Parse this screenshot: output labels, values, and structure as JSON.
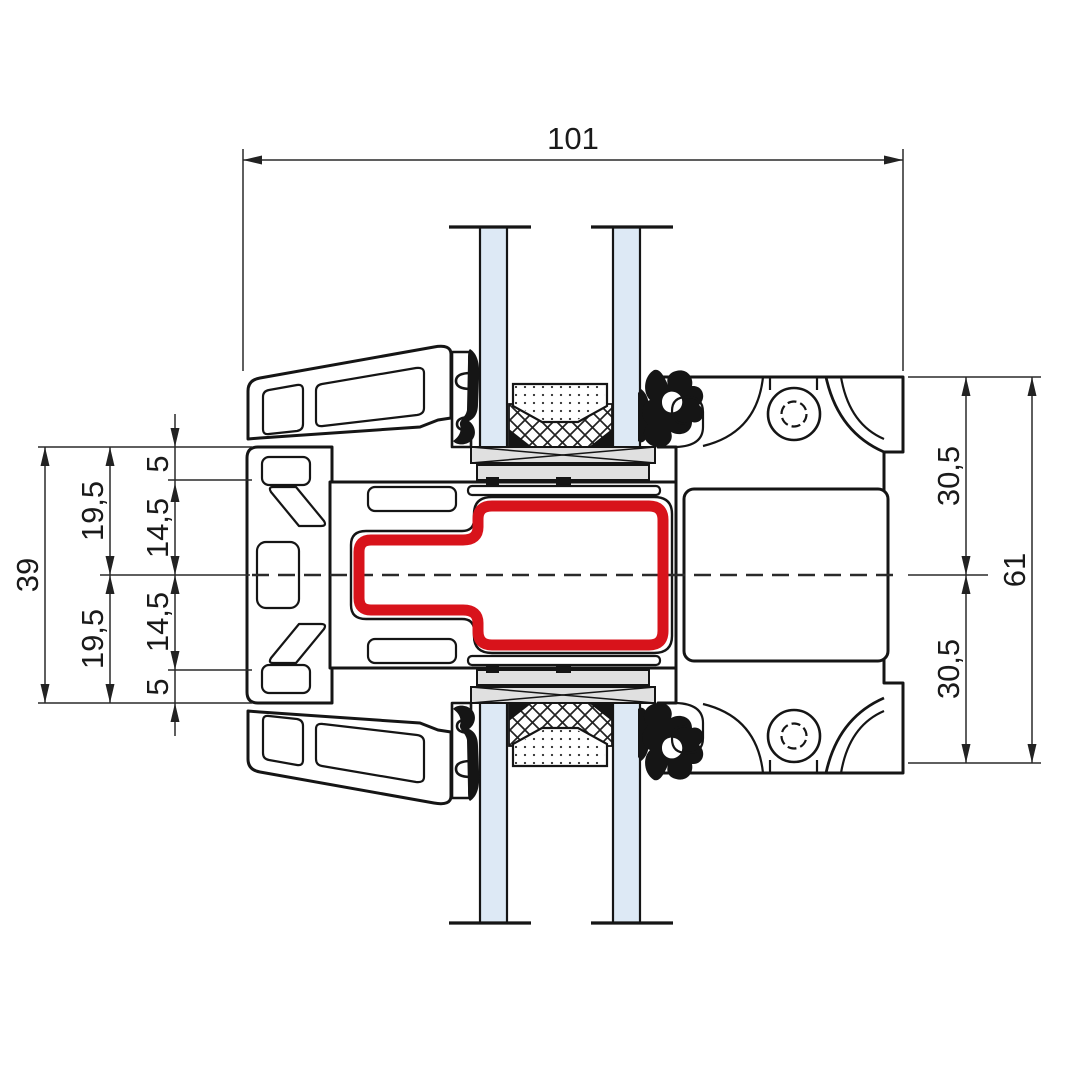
{
  "drawing": {
    "title": "Window mullion profile cross-section",
    "dimensions": {
      "total_width": "101",
      "left_overall": "39",
      "left_upper_half": "19,5",
      "left_lower_half": "19,5",
      "left_wall_top": "5",
      "left_inner_upper": "14,5",
      "left_inner_lower": "14,5",
      "left_wall_bottom": "5",
      "right_upper_half": "30,5",
      "right_lower_half": "30,5",
      "right_overall": "61"
    },
    "colors": {
      "steel_reinforcement": "#d8131b",
      "glass": "#dde9f5",
      "hardware_gray": "#e0e0e0",
      "line": "#151515"
    }
  }
}
